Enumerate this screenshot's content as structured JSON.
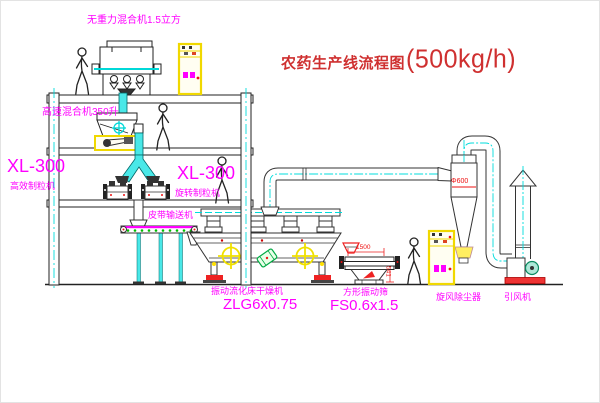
{
  "title": {
    "name_cn": "农药生产线流程图",
    "capacity": "(500kg/h)"
  },
  "equipment": {
    "gravity_mixer": {
      "label": "无重力混合机1.5立方"
    },
    "high_speed_mixer": {
      "label": "高速混合机350升"
    },
    "granulator_a": {
      "model": "XL-300",
      "name": "高效制粒机"
    },
    "granulator_b": {
      "model": "XL-300",
      "name": "旋转制粒机"
    },
    "belt_conveyor": {
      "name": "皮带输送机"
    },
    "fluid_bed_dryer": {
      "name": "振动流化床干燥机",
      "model": "ZLG6x0.75"
    },
    "square_sieve": {
      "name": "方形振动筛",
      "model": "FS0.6x1.5"
    },
    "cyclone": {
      "name": "旋风除尘器",
      "dimension": "Φ600"
    },
    "induced_draft_fan": {
      "name": "引风机"
    }
  },
  "dimensions": {
    "sieve_length": "1500",
    "sieve_height": "541"
  },
  "colors": {
    "label_magenta": "#ff00ff",
    "title_red": "#cf3030",
    "dimension_red": "#ee1111",
    "centerline_cyan": "#00dcdc",
    "cabinet_yellow": "#f0d800",
    "line_black": "#222222",
    "accent_green": "#00aa44"
  }
}
